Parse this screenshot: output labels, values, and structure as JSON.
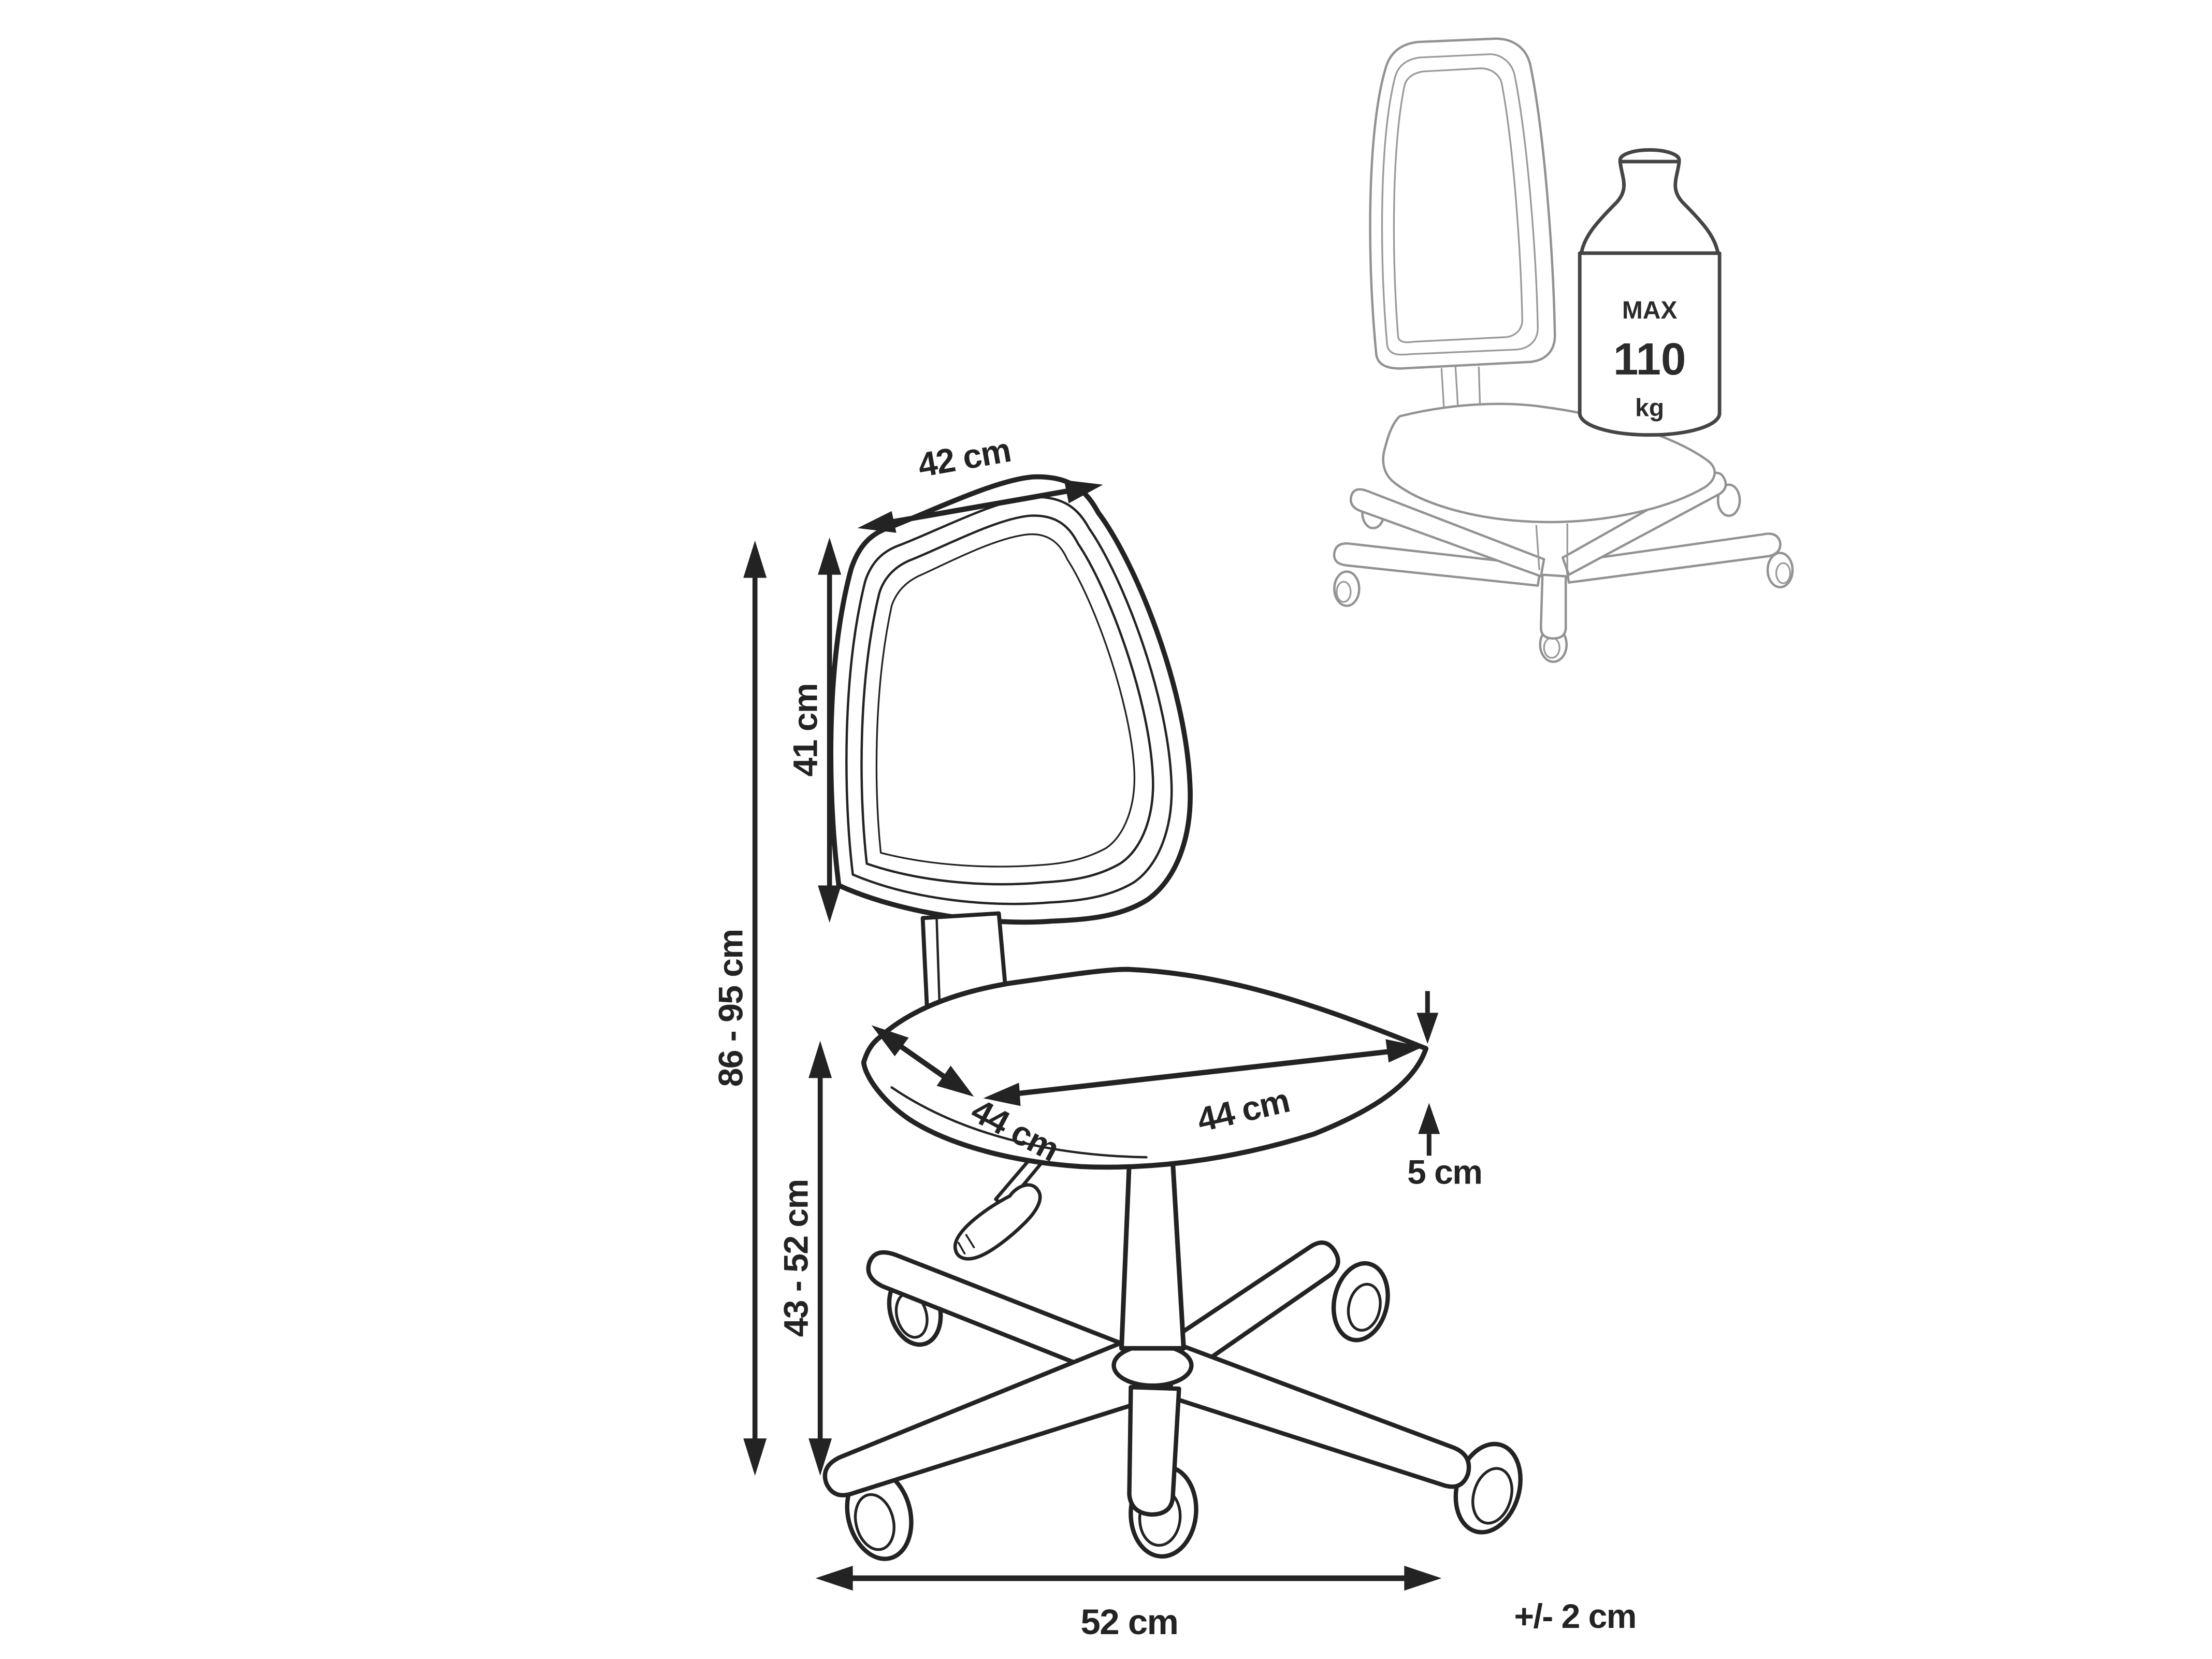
{
  "figure": {
    "background": "#ffffff",
    "ink_color": "#232323",
    "inset_ink_color": "#929292",
    "subject": "office swivel chair dimension diagram"
  },
  "dimensions": {
    "backrest_width": "42 cm",
    "backrest_height": "41 cm",
    "overall_height": "86 - 95 cm",
    "seat_height": "43 - 52 cm",
    "seat_width": "44 cm",
    "seat_depth": "44 cm",
    "seat_thickness": "5 cm",
    "base_width": "52 cm",
    "tolerance": "+/- 2 cm"
  },
  "max_load": {
    "label": "MAX",
    "value": "110",
    "unit": "kg"
  }
}
